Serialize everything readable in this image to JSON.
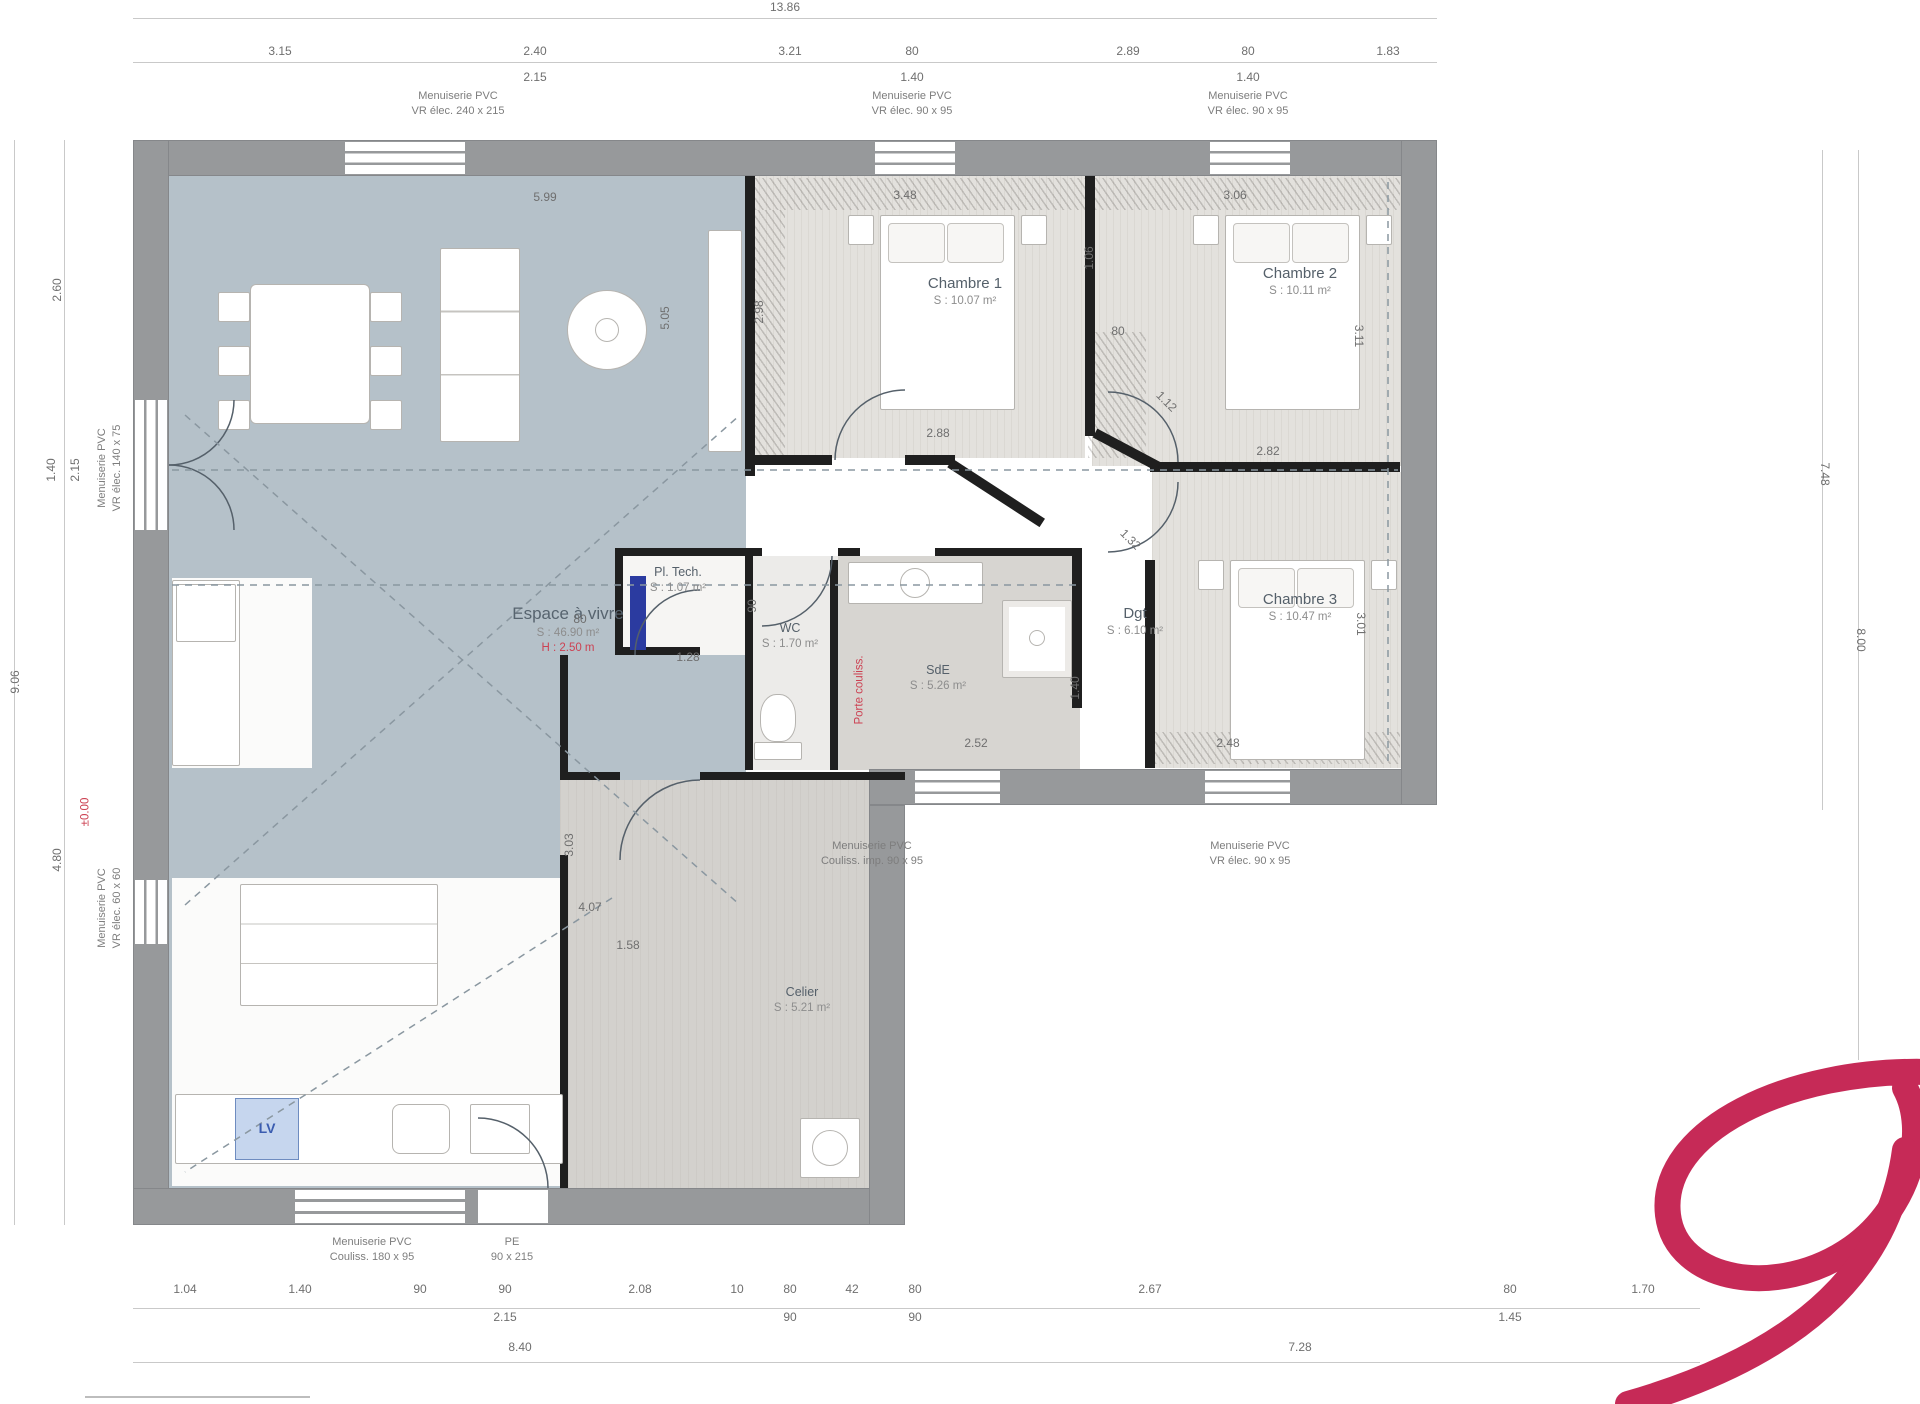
{
  "rooms": {
    "living": {
      "name": "Espace à vivre",
      "area": "S : 46.90 m²",
      "note": "H : 2.50 m"
    },
    "chambre1": {
      "name": "Chambre 1",
      "area": "S : 10.07 m²"
    },
    "chambre2": {
      "name": "Chambre 2",
      "area": "S : 10.11 m²"
    },
    "chambre3": {
      "name": "Chambre 3",
      "area": "S : 10.47 m²"
    },
    "dgt": {
      "name": "Dgt",
      "area": "S : 6.10 m²"
    },
    "wc": {
      "name": "WC",
      "area": "S : 1.70 m²"
    },
    "sde": {
      "name": "SdE",
      "area": "S : 5.26 m²"
    },
    "cellier": {
      "name": "Celier",
      "area": "S : 5.21 m²"
    },
    "pltech": {
      "name": "Pl. Tech.",
      "area": "S : 1.07 m²"
    }
  },
  "colors": {
    "wall": "#97999b",
    "partition": "#1f1f1f",
    "living_floor": "#b5c1c9",
    "bedroom_floor": "#e3e1dd",
    "accent_red": "#cc4152",
    "logo": "#c62a57",
    "dim_text": "#6f6f6f"
  },
  "annotations": [
    {
      "t": "13.86",
      "x": 785,
      "y": 8
    },
    {
      "t": "3.15",
      "x": 280,
      "y": 52
    },
    {
      "t": "2.40",
      "x": 535,
      "y": 52
    },
    {
      "t": "2.15",
      "x": 535,
      "y": 78
    },
    {
      "t": "3.21",
      "x": 790,
      "y": 52
    },
    {
      "t": "80",
      "x": 912,
      "y": 52
    },
    {
      "t": "1.40",
      "x": 912,
      "y": 78
    },
    {
      "t": "2.89",
      "x": 1128,
      "y": 52
    },
    {
      "t": "80",
      "x": 1248,
      "y": 52
    },
    {
      "t": "1.40",
      "x": 1248,
      "y": 78
    },
    {
      "t": "1.83",
      "x": 1388,
      "y": 52
    },
    {
      "t": "Menuiserie PVC\nVR élec.  240 x 215",
      "x": 458,
      "y": 104,
      "c": "lbl"
    },
    {
      "t": "Menuiserie PVC\nVR élec.  90 x 95",
      "x": 912,
      "y": 104,
      "c": "lbl"
    },
    {
      "t": "Menuiserie PVC\nVR élec.  90 x 95",
      "x": 1248,
      "y": 104,
      "c": "lbl"
    },
    {
      "t": "9.06",
      "x": 16,
      "y": 682,
      "r": -90
    },
    {
      "t": "2.60",
      "x": 58,
      "y": 290,
      "r": -90
    },
    {
      "t": "1.40",
      "x": 52,
      "y": 470,
      "r": -90
    },
    {
      "t": "2.15",
      "x": 76,
      "y": 470,
      "r": -90
    },
    {
      "t": "4.80",
      "x": 58,
      "y": 860,
      "r": -90
    },
    {
      "t": "Menuiserie PVC\nVR élec.  140 x 75",
      "x": 110,
      "y": 468,
      "r": -90,
      "c": "lbl"
    },
    {
      "t": "Menuiserie PVC\nVR élec.  60 x 60",
      "x": 110,
      "y": 908,
      "r": -90,
      "c": "lbl"
    },
    {
      "t": "±0.00",
      "x": 86,
      "y": 812,
      "r": -90,
      "c": "red"
    },
    {
      "t": "7.48",
      "x": 1824,
      "y": 474,
      "r": 90
    },
    {
      "t": "8.00",
      "x": 1860,
      "y": 640,
      "r": 90
    },
    {
      "t": "1.04",
      "x": 185,
      "y": 1290
    },
    {
      "t": "1.40",
      "x": 300,
      "y": 1290
    },
    {
      "t": "90",
      "x": 420,
      "y": 1290
    },
    {
      "t": "90",
      "x": 505,
      "y": 1290
    },
    {
      "t": "2.15",
      "x": 505,
      "y": 1318
    },
    {
      "t": "2.08",
      "x": 640,
      "y": 1290
    },
    {
      "t": "10",
      "x": 737,
      "y": 1290
    },
    {
      "t": "80",
      "x": 790,
      "y": 1290
    },
    {
      "t": "90",
      "x": 790,
      "y": 1318
    },
    {
      "t": "42",
      "x": 852,
      "y": 1290
    },
    {
      "t": "80",
      "x": 915,
      "y": 1290
    },
    {
      "t": "90",
      "x": 915,
      "y": 1318
    },
    {
      "t": "2.67",
      "x": 1150,
      "y": 1290
    },
    {
      "t": "80",
      "x": 1510,
      "y": 1290
    },
    {
      "t": "1.45",
      "x": 1510,
      "y": 1318
    },
    {
      "t": "1.70",
      "x": 1643,
      "y": 1290
    },
    {
      "t": "8.40",
      "x": 520,
      "y": 1348
    },
    {
      "t": "7.28",
      "x": 1300,
      "y": 1348
    },
    {
      "t": "Menuiserie PVC\nCouliss.  180 x 95",
      "x": 372,
      "y": 1250,
      "c": "lbl"
    },
    {
      "t": "PE\n90 x 215",
      "x": 512,
      "y": 1250,
      "c": "lbl"
    },
    {
      "t": "Menuiserie PVC\nCouliss. imp.  90 x 95",
      "x": 872,
      "y": 854,
      "c": "lbl"
    },
    {
      "t": "Menuiserie PVC\nVR élec.  90 x 95",
      "x": 1250,
      "y": 854,
      "c": "lbl"
    },
    {
      "t": "5.99",
      "x": 545,
      "y": 198
    },
    {
      "t": "5.05",
      "x": 666,
      "y": 318,
      "r": -90
    },
    {
      "t": "3.48",
      "x": 905,
      "y": 196
    },
    {
      "t": "3.06",
      "x": 1235,
      "y": 196
    },
    {
      "t": "2.98",
      "x": 760,
      "y": 312,
      "r": -90
    },
    {
      "t": "1.06",
      "x": 1090,
      "y": 258,
      "r": -90
    },
    {
      "t": "2.88",
      "x": 938,
      "y": 434
    },
    {
      "t": "80",
      "x": 1118,
      "y": 332
    },
    {
      "t": "1.12",
      "x": 1166,
      "y": 402,
      "r": 45
    },
    {
      "t": "2.82",
      "x": 1268,
      "y": 452
    },
    {
      "t": "3.11",
      "x": 1358,
      "y": 336,
      "r": 90
    },
    {
      "t": "1.32",
      "x": 1130,
      "y": 540,
      "r": 45
    },
    {
      "t": "3.01",
      "x": 1360,
      "y": 624,
      "r": 90
    },
    {
      "t": "2.48",
      "x": 1228,
      "y": 744
    },
    {
      "t": "2.52",
      "x": 976,
      "y": 744
    },
    {
      "t": "1.40",
      "x": 1076,
      "y": 688,
      "r": -90
    },
    {
      "t": "90",
      "x": 753,
      "y": 606,
      "r": -90
    },
    {
      "t": "80",
      "x": 580,
      "y": 620
    },
    {
      "t": "1.28",
      "x": 688,
      "y": 658
    },
    {
      "t": "4.07",
      "x": 590,
      "y": 908
    },
    {
      "t": "1.58",
      "x": 628,
      "y": 946
    },
    {
      "t": "3.03",
      "x": 570,
      "y": 845,
      "r": -90
    },
    {
      "t": "LV",
      "x": 267,
      "y": 1128,
      "c": "blue"
    },
    {
      "t": "Porte couliss.",
      "x": 860,
      "y": 690,
      "r": -90,
      "c": "red"
    }
  ]
}
